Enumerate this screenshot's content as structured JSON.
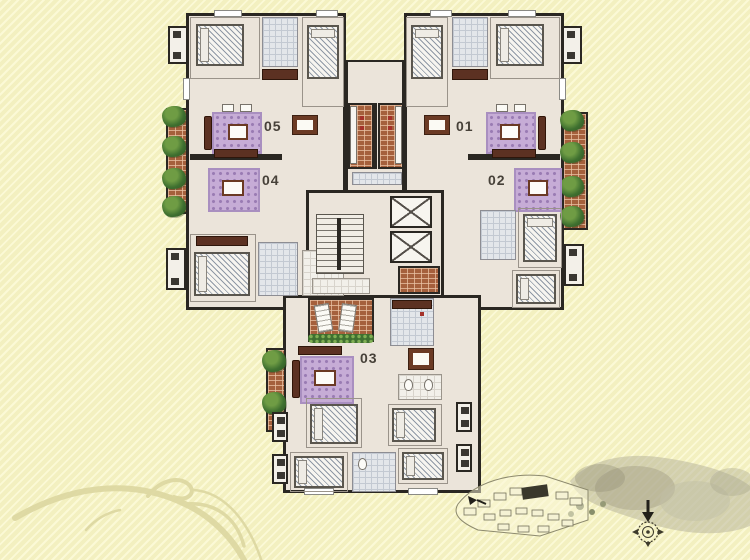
{
  "plan": {
    "unit_05": {
      "label": "05"
    },
    "unit_04": {
      "label": "04"
    },
    "unit_01": {
      "label": "01"
    },
    "unit_02": {
      "label": "02"
    },
    "unit_03": {
      "label": "03"
    }
  },
  "palette": {
    "background_base": "#f3f0c0",
    "background_stripe": "#fbf9d6",
    "wall": "#2a2722",
    "floor": "#ebe4da",
    "balcony_brick": "#a5603c",
    "plant_green": "#3f7030",
    "rug_purple": "#c6acd6",
    "furniture_brown": "#5c3122",
    "bath_tile_gray": "#e3e6ea",
    "flourish": "#dcd7a0",
    "site_highlight_building": "#3a382c"
  },
  "icons": {
    "compass": "compass-icon",
    "north_arrow": "north-arrow-icon",
    "plants": "plant-icon",
    "elevators": "elevator-icon",
    "stairs": "stairs-icon"
  }
}
